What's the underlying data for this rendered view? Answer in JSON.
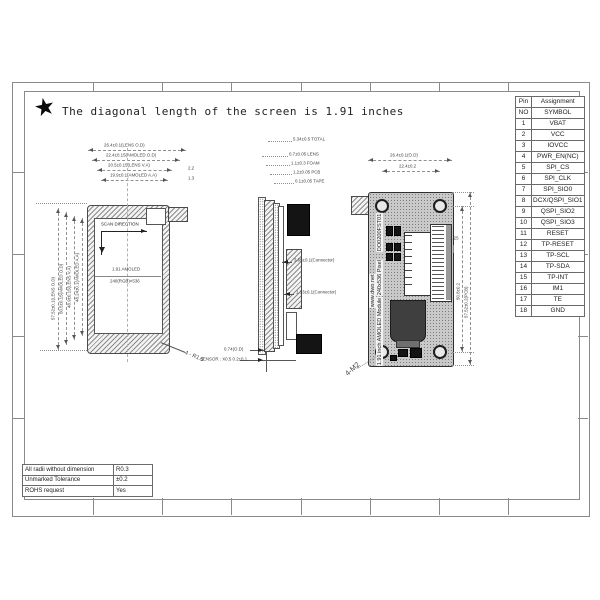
{
  "title": {
    "star_icon": "★",
    "text": "The diagonal length of the screen is 1.91 inches"
  },
  "pin_table": {
    "header_row1": [
      "Pin",
      "Assignment"
    ],
    "header_row2": [
      "NO",
      "SYMBOL"
    ],
    "rows": [
      [
        "1",
        "VBAT"
      ],
      [
        "2",
        "VCC"
      ],
      [
        "3",
        "IOVCC"
      ],
      [
        "4",
        "PWR_EN(NC)"
      ],
      [
        "5",
        "SPI_CS"
      ],
      [
        "6",
        "SPI_CLK"
      ],
      [
        "7",
        "SPI_SIO0"
      ],
      [
        "8",
        "DCX/QSPI_SIO1"
      ],
      [
        "9",
        "QSPI_SIO2"
      ],
      [
        "10",
        "QSPI_SIO3"
      ],
      [
        "11",
        "RESET"
      ],
      [
        "12",
        "TP-RESET"
      ],
      [
        "13",
        "TP-SCL"
      ],
      [
        "14",
        "TP-SDA"
      ],
      [
        "15",
        "TP-INT"
      ],
      [
        "16",
        "IM1"
      ],
      [
        "17",
        "TE"
      ],
      [
        "18",
        "GND"
      ]
    ]
  },
  "tolerance_table": {
    "rows": [
      [
        "All radii without dimension",
        "R0.3"
      ],
      [
        "Unmarked Tolerance",
        "±0.2"
      ],
      [
        "ROHS request",
        "Yes"
      ]
    ]
  },
  "front_view": {
    "scan_direction": "SCAN DIRECTION",
    "panel_label_line1": "1.91 AMOLED",
    "panel_label_line2": "240(RGB)×536",
    "dims_top": [
      "26.4±0.1(LENS O.D)",
      "22.4±0.15(AMOLED O.D)",
      "20.5±0.15(LENS V.A)",
      "19.9±0.1(AMOLED A.A)"
    ],
    "dims_top_notes": [
      "2.2",
      "1.3"
    ],
    "dims_left": [
      "57.52±0.1(LENS O.D)",
      "50.5±0.15(AMOLED O.D)",
      "48.9±0.15(LENS V.A)",
      "48.24±0.1(AMOLED A.A)"
    ],
    "corner_radius_label": "4 - R1.5"
  },
  "side_view": {
    "stack_dims": [
      "5.34±0.5 TOTAL",
      "0.7±0.05 LENS",
      "1.1±0.3 FOAM",
      "1.2±0.05 PCB",
      "0.1±0.05 TAPE"
    ],
    "connector_dim_1": "3.65±0.1(Connector)",
    "connector_dim_2": "1.33±0.1(Connector)",
    "outline_dim": "0.74(O.D)",
    "sensor_note": "SENSOR : X0.5 0.2±0.1"
  },
  "back_view": {
    "pcb_text_url": "www.dwo.net",
    "pcb_text_part": "DO0200FST01",
    "pcb_text_res": "240x536 Pixel",
    "pcb_text_name": "1.91 inch AMOLED Module",
    "dims_top": [
      "26.4±0.1(O.D)",
      "22.4±0.2"
    ],
    "dims_right": [
      "50.8±0.2",
      "57.52±0.2(PCB)"
    ],
    "dim_small": "1.25",
    "screw_label": "4-M2"
  }
}
